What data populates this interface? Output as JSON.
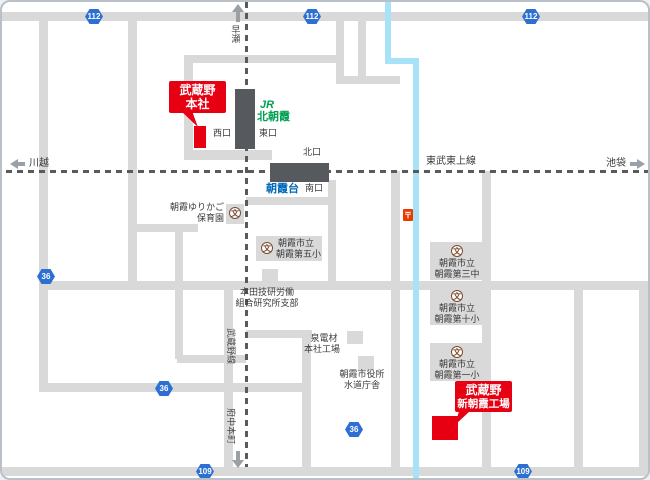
{
  "map": {
    "railways": {
      "musashino_line_label": "武蔵野線",
      "tobu_tojo_label": "東武東上線",
      "dir_up": "早瀬",
      "dir_down": "府中本町",
      "dir_left": "川越",
      "dir_right": "池袋"
    },
    "stations": {
      "kita_asaka": {
        "jr_logo": "JR",
        "name": "北朝霞",
        "west_exit": "西口",
        "east_exit": "東口"
      },
      "asakadai": {
        "name": "朝霞台",
        "north_exit": "北口",
        "south_exit": "南口"
      }
    },
    "markers": {
      "headquarters": {
        "line1": "武蔵野",
        "line2": "本社"
      },
      "factory": {
        "line1": "武蔵野",
        "line2": "新朝霞工場"
      }
    },
    "pois": {
      "nursery": {
        "line1": "朝霞ゆりかご",
        "line2": "保育園"
      },
      "school5": {
        "line1": "朝霞市立",
        "line2": "朝霞第五小"
      },
      "honda": {
        "line1": "本田技研労働",
        "line2": "組合研究所支部"
      },
      "izumi": {
        "line1": "泉電材",
        "line2": "本社工場"
      },
      "cityhall": {
        "line1": "朝霞市役所",
        "line2": "水道庁舎"
      },
      "school3c": {
        "line1": "朝霞市立",
        "line2": "朝霞第三中"
      },
      "school10": {
        "line1": "朝霞市立",
        "line2": "朝霞第十小"
      },
      "school1": {
        "line1": "朝霞市立",
        "line2": "朝霞第一小"
      }
    },
    "symbols": {
      "school_icon_char": "文",
      "post_office_mark": "〒"
    },
    "route_shields": [
      {
        "number": "112"
      },
      {
        "number": "112"
      },
      {
        "number": "112"
      },
      {
        "number": "36"
      },
      {
        "number": "36"
      },
      {
        "number": "36"
      },
      {
        "number": "109"
      },
      {
        "number": "109"
      }
    ],
    "colors": {
      "marker_red": "#e60012",
      "shield_blue": "#2e6fd2",
      "jr_green": "#00a051",
      "tobu_blue": "#0068b7",
      "river_blue": "#a8e2f8",
      "road_gray": "#d9d9d9",
      "station_gray": "#56595d"
    }
  }
}
